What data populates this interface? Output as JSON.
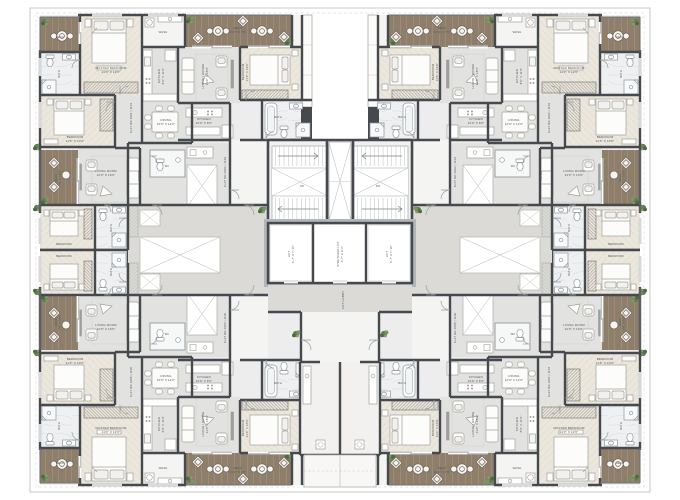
{
  "title": "Typical Floor Plan",
  "colors": {
    "wall": "#46494d",
    "wall_light": "#9b9ea1",
    "floor_base": "#ecedec",
    "floor_bedroom": "#ece7dd",
    "floor_bath": "#eef0f1",
    "floor_living": "#e2e3e1",
    "floor_deck": "#8e7e6a",
    "floor_corridor": "#dbdad6",
    "floor_core": "#f0f1f0",
    "plant_green": "#5f7d4e",
    "frame": "#c9c9c6",
    "label_text": "#54575b"
  },
  "flats": [
    {
      "id": "FLAT NO 1001 | 1101",
      "quadrant": "top-left-outer"
    },
    {
      "id": "FLAT NO 1002 | 1102",
      "quadrant": "top-left-inner"
    },
    {
      "id": "FLAT NO 1003 | 1103",
      "quadrant": "top-right-outer"
    },
    {
      "id": "FLAT NO 1004 | 1104",
      "quadrant": "top-right-inner"
    },
    {
      "id": "FLAT NO 1005 | 1105",
      "quadrant": "bottom-left-outer"
    },
    {
      "id": "FLAT NO 1006 | 1106",
      "quadrant": "bottom-left-inner"
    },
    {
      "id": "FLAT NO 1007 | 1107",
      "quadrant": "bottom-right-outer"
    },
    {
      "id": "FLAT NO 1008 | 1108",
      "quadrant": "bottom-right-inner"
    }
  ],
  "labels": {
    "quadrant": [
      {
        "lines": [
          "DECK"
        ],
        "x": 60,
        "y": 37,
        "r": 0,
        "s": 2.8
      },
      {
        "lines": [
          "MASTER BEDROOM",
          "11′0″ X 12′6″"
        ],
        "x": 111,
        "y": 70,
        "r": 0,
        "s": 3
      },
      {
        "lines": [
          "BATH"
        ],
        "x": 59,
        "y": 74,
        "r": -90,
        "s": 2.7
      },
      {
        "lines": [
          "BEDROOM",
          "11′6″ X 10′0″"
        ],
        "x": 75,
        "y": 139,
        "r": 0,
        "s": 3
      },
      {
        "lines": [
          "DECK",
          "7′0″ X 19′6″"
        ],
        "x": 58,
        "y": 178,
        "r": -90,
        "s": 2.7
      },
      {
        "lines": [
          "LIVING ROOM",
          "12′0″ X 16′0″"
        ],
        "x": 106,
        "y": 173,
        "r": 0,
        "s": 3
      },
      {
        "lines": [
          "BEDROOM"
        ],
        "x": 64,
        "y": 244,
        "r": 0,
        "s": 2.8
      },
      {
        "lines": [
          "BATH"
        ],
        "x": 111,
        "y": 228,
        "r": -90,
        "s": 2.7
      },
      {
        "lines": [
          "WASH"
        ],
        "x": 163,
        "y": 32,
        "r": 0,
        "s": 2.8
      },
      {
        "lines": [
          "KITCHEN",
          "8′0″ X 11′0″"
        ],
        "x": 161,
        "y": 76,
        "r": -90,
        "s": 3
      },
      {
        "lines": [
          "DINING",
          "10′0″ X 12′0″"
        ],
        "x": 166,
        "y": 122,
        "r": 0,
        "s": 2.9
      },
      {
        "lines": [
          "DECK",
          "21′0″ X 7′6″"
        ],
        "x": 238,
        "y": 30,
        "r": 0,
        "s": 2.9
      },
      {
        "lines": [
          "LIVING / DINING",
          "11′0″ X 18′6″"
        ],
        "x": 205,
        "y": 76,
        "r": -90,
        "s": 3
      },
      {
        "lines": [
          "KITCHEN",
          "10′6″ X 8′0″"
        ],
        "x": 204,
        "y": 121,
        "r": 0,
        "s": 2.9
      },
      {
        "lines": [
          "BEDROOM",
          "11′0″ X 10′0″"
        ],
        "x": 245,
        "y": 72,
        "r": -90,
        "s": 3
      },
      {
        "lines": [
          "BATH"
        ],
        "x": 278,
        "y": 117,
        "r": 0,
        "s": 2.7
      },
      {
        "lines": [
          "FOYER"
        ],
        "x": 139,
        "y": 176,
        "r": -90,
        "s": 2.7
      },
      {
        "lines": [
          "WC"
        ],
        "x": 167,
        "y": 166,
        "r": 0,
        "s": 2.5
      }
    ],
    "per_quadrant": [
      {
        "q": "tl",
        "lines": [
          "FLAT NO 1001 | 1101"
        ],
        "x": 131,
        "y": 118,
        "r": -90,
        "s": 2.9
      },
      {
        "q": "tl",
        "lines": [
          "FLAT NO 1002 | 1102"
        ],
        "x": 225,
        "y": 172,
        "r": -90,
        "s": 2.9
      },
      {
        "q": "tr",
        "lines": [
          "FLAT NO 1003 | 1103"
        ],
        "x": 549,
        "y": 118,
        "r": -90,
        "s": 2.9
      },
      {
        "q": "tr",
        "lines": [
          "FLAT NO 1004 | 1104"
        ],
        "x": 455,
        "y": 172,
        "r": -90,
        "s": 2.9
      },
      {
        "q": "bl",
        "lines": [
          "FLAT NO 1005 | 1105"
        ],
        "x": 131,
        "y": 382,
        "r": -90,
        "s": 2.9
      },
      {
        "q": "bl",
        "lines": [
          "FLAT NO 1006 | 1106"
        ],
        "x": 225,
        "y": 328,
        "r": -90,
        "s": 2.9
      },
      {
        "q": "br",
        "lines": [
          "FLAT NO 1007 | 1107"
        ],
        "x": 549,
        "y": 382,
        "r": -90,
        "s": 2.9
      },
      {
        "q": "br",
        "lines": [
          "FLAT NO 1008 | 1108"
        ],
        "x": 455,
        "y": 328,
        "r": -90,
        "s": 2.9
      }
    ],
    "core": [
      {
        "lines": [
          "LIFT",
          "6′-7″ X 7′-10″"
        ],
        "x": 291,
        "y": 254,
        "r": -90,
        "s": 2.8
      },
      {
        "lines": [
          "STRETCHER LIFT",
          "6′-7″ X 9′-0″"
        ],
        "x": 340,
        "y": 254,
        "r": -90,
        "s": 2.8
      },
      {
        "lines": [
          "LIFT",
          "6′-7″ X 7′-10″"
        ],
        "x": 389,
        "y": 254,
        "r": -90,
        "s": 2.8
      },
      {
        "lines": [
          "LIFT LOBBY"
        ],
        "x": 343,
        "y": 300,
        "r": -90,
        "s": 3
      },
      {
        "lines": [
          "UP"
        ],
        "x": 302,
        "y": 186,
        "r": 0,
        "s": 2.8
      },
      {
        "lines": [
          "DN"
        ],
        "x": 378,
        "y": 186,
        "r": 0,
        "s": 2.8
      }
    ]
  }
}
